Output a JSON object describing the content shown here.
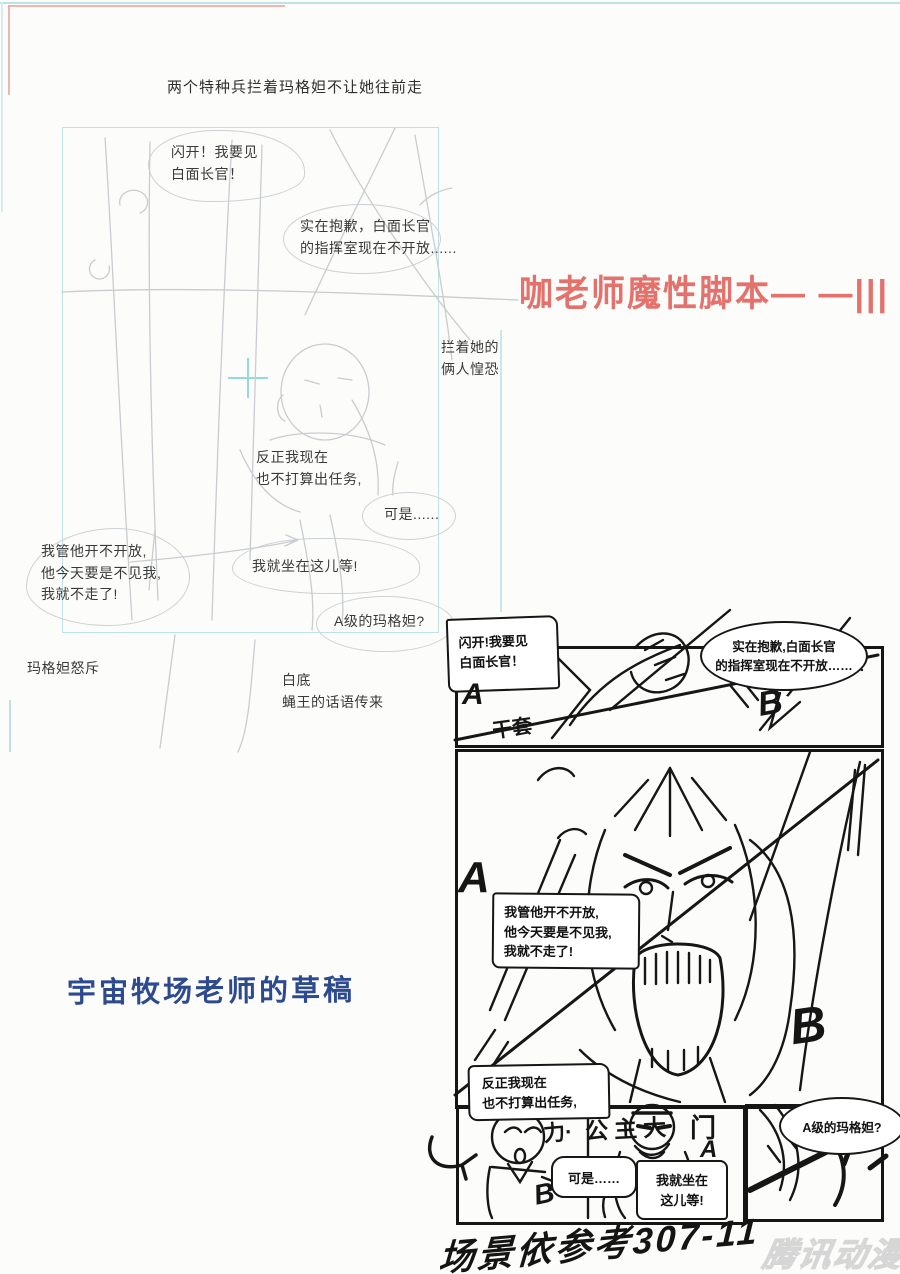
{
  "colors": {
    "background": "#fcfcfa",
    "cyan_line": "#bfe2e4",
    "red_line": "#e59a93",
    "red_title": "#e4716c",
    "blue_caption": "#2d4a8e",
    "ink": "#161616",
    "faint_sketch": "#c9ccd0",
    "watermark_gray": "#d6d6d6"
  },
  "storyboard": {
    "caption": "两个特种兵拦着玛格妲不让她往前走",
    "bubbles": {
      "shankai": "闪开！我要见\n白面长官！",
      "shizai": "实在抱歉，白面长官\n的指挥室现在不开放......",
      "lanzhe": "拦着她的\n俩人惶恐",
      "fanzheng": "反正我现在\n也不打算出任务,",
      "keshi": "可是......",
      "woguan": "我管他开不开放,\n他今天要是不见我,\n我就不走了!",
      "wojiuzuo": "我就坐在这儿等!",
      "aji": "A级的玛格妲?"
    },
    "labels": {
      "nuchi": "玛格妲怒斥",
      "baidi": "白底\n蝇王的话语传来"
    }
  },
  "annotations": {
    "red_title": "咖老师魔性脚本— —|||",
    "blue_caption": "宇宙牧场老师的草稿",
    "scene_note": "场景依参考307-11",
    "watermark": "腾讯动漫"
  },
  "sketch": {
    "bubbles": {
      "shankai": "闪开!我要见\n白面长官！",
      "shizai": "实在抱歉,白面长官\n的指挥室现在不开放……",
      "woguan": "我管他开不开放,\n他今天要是不见我,\n我就不走了!",
      "fanzheng": "反正我现在\n也不打算出任务,",
      "keshi": "可是……",
      "wojiuzuo": "我就坐在\n这儿等!",
      "aji": "A级的玛格妲?"
    },
    "labels": {
      "a1": "A",
      "scribble1": "干套",
      "b1": "B",
      "a2": "A",
      "b2": "B",
      "li": "力·",
      "gongzhu": "公主大",
      "men": "门",
      "men_a": "A",
      "b3": "B"
    }
  }
}
